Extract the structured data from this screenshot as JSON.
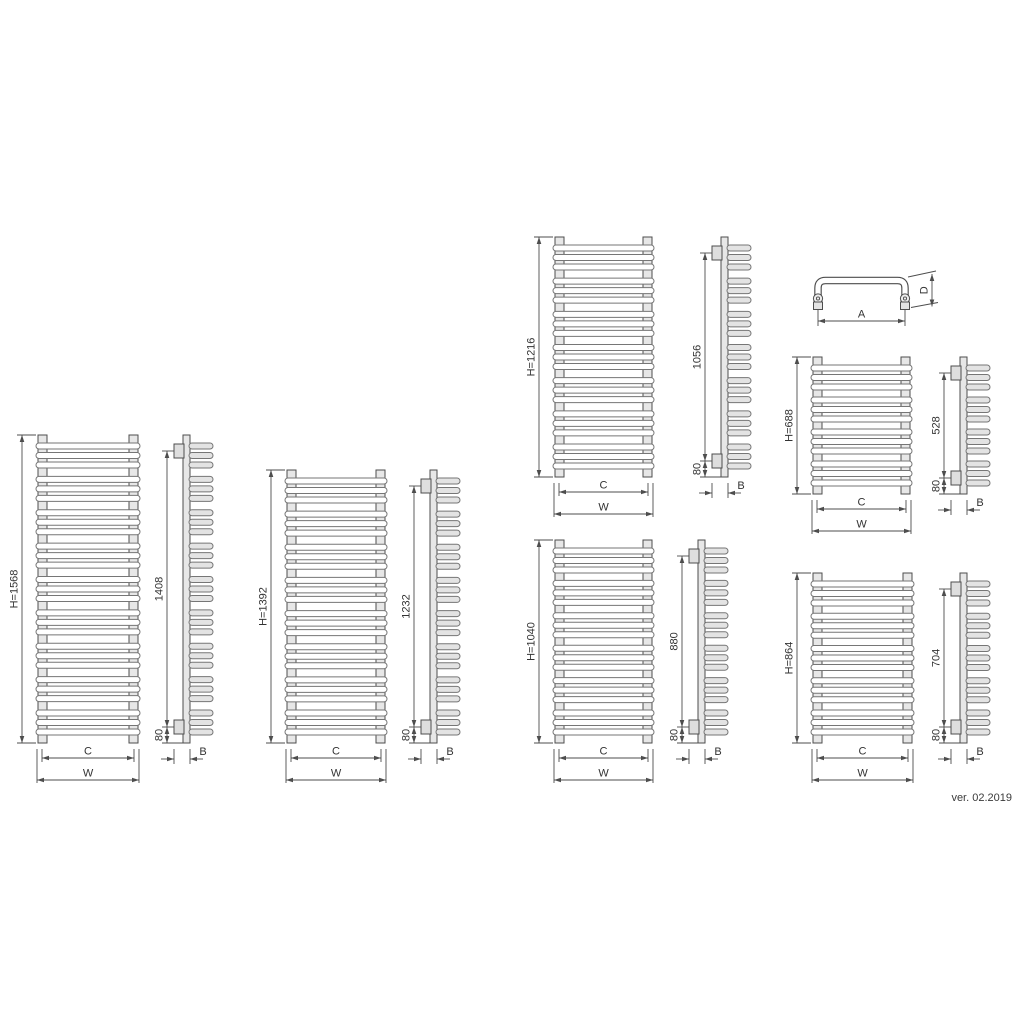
{
  "footer": {
    "version_label": "ver. 02.2019"
  },
  "dim_labels": {
    "width_inner": "C",
    "width_outer": "W",
    "depth": "B"
  },
  "colors": {
    "line": "#4d4d4d",
    "tube_stroke": "#767676",
    "rail_fill": "#e7e7e7",
    "tube_fill": "#ffffff",
    "prong_fill": "#e3e3e3",
    "bracket_fill": "#dedede",
    "text": "#333333",
    "background": "#ffffff"
  },
  "radiators": [
    {
      "name": "h1568",
      "height_label": "H=1568",
      "mount_span_label": "1408",
      "bottom_offset_label": "80",
      "tube_groups": 9,
      "tubes_per_group": 3,
      "layout": {
        "front": {
          "x": 38,
          "y": 435,
          "w": 100,
          "h": 308
        },
        "side": {
          "x": 183,
          "y": 435,
          "h": 308
        }
      }
    },
    {
      "name": "h1392",
      "height_label": "H=1392",
      "mount_span_label": "1232",
      "bottom_offset_label": "80",
      "tube_groups": 8,
      "tubes_per_group": 3,
      "layout": {
        "front": {
          "x": 287,
          "y": 470,
          "w": 98,
          "h": 273
        },
        "side": {
          "x": 430,
          "y": 470,
          "h": 273
        }
      }
    },
    {
      "name": "h1216",
      "height_label": "H=1216",
      "mount_span_label": "1056",
      "bottom_offset_label": "80",
      "tube_groups": 7,
      "tubes_per_group": 3,
      "layout": {
        "front": {
          "x": 555,
          "y": 237,
          "w": 97,
          "h": 240
        },
        "side": {
          "x": 721,
          "y": 237,
          "h": 240
        }
      }
    },
    {
      "name": "h1040",
      "height_label": "H=1040",
      "mount_span_label": "880",
      "bottom_offset_label": "80",
      "tube_groups": 6,
      "tubes_per_group": 3,
      "layout": {
        "front": {
          "x": 555,
          "y": 540,
          "w": 97,
          "h": 203
        },
        "side": {
          "x": 698,
          "y": 540,
          "h": 203
        }
      }
    },
    {
      "name": "h688",
      "height_label": "H=688",
      "mount_span_label": "528",
      "bottom_offset_label": "80",
      "tube_groups": 4,
      "tubes_per_group": 3,
      "layout": {
        "front": {
          "x": 813,
          "y": 357,
          "w": 97,
          "h": 137
        },
        "side": {
          "x": 960,
          "y": 357,
          "h": 137
        }
      }
    },
    {
      "name": "h864",
      "height_label": "H=864",
      "mount_span_label": "704",
      "bottom_offset_label": "80",
      "tube_groups": 5,
      "tubes_per_group": 3,
      "layout": {
        "front": {
          "x": 813,
          "y": 573,
          "w": 99,
          "h": 170
        },
        "side": {
          "x": 960,
          "y": 573,
          "h": 170
        }
      }
    }
  ],
  "top_view": {
    "width_label": "A",
    "depth_label": "D",
    "layout": {
      "left_x": 818,
      "right_x": 905,
      "top_y": 280.5,
      "leg_bottom": 297,
      "fitting_cy": 298.5,
      "square_y": 302,
      "dim_x": 932,
      "a_y": 321
    }
  }
}
